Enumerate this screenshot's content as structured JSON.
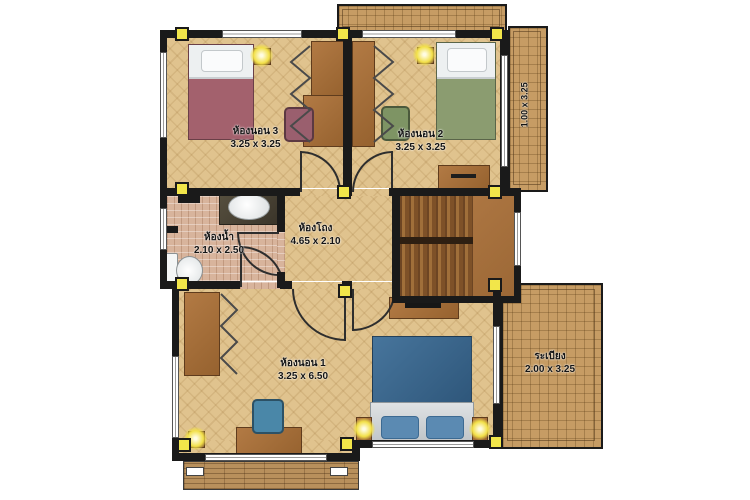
{
  "rooms": {
    "bedroom3": {
      "label": "ห้องนอน 3",
      "size": "3.25 x 3.25"
    },
    "bedroom2": {
      "label": "ห้องนอน 2",
      "size": "3.25 x 3.25"
    },
    "hall": {
      "label": "ห้องโถง",
      "size": "4.65 x 2.10"
    },
    "bathroom": {
      "label": "ห้องน้ำ",
      "size": "2.10 x 2.50"
    },
    "bedroom1": {
      "label": "ห้องนอน 1",
      "size": "3.25 x 6.50"
    },
    "balcony": {
      "label": "ระเบียง",
      "size": "2.00 x 3.25"
    },
    "side_balcony": {
      "size": "1.00 x 3.25"
    }
  },
  "colors": {
    "wall": "#1a1a1a",
    "column": "#f2e64a",
    "parquet": "#e0c38e",
    "bath_tile": "#d8b49c",
    "balcony_tile": "#c69c64",
    "deck": "#b8905c",
    "bed_maroon": "#a3616d",
    "bed_green": "#8b9c70",
    "bed_blue": "#3f6f95",
    "furniture_wood": "#a8733f"
  }
}
